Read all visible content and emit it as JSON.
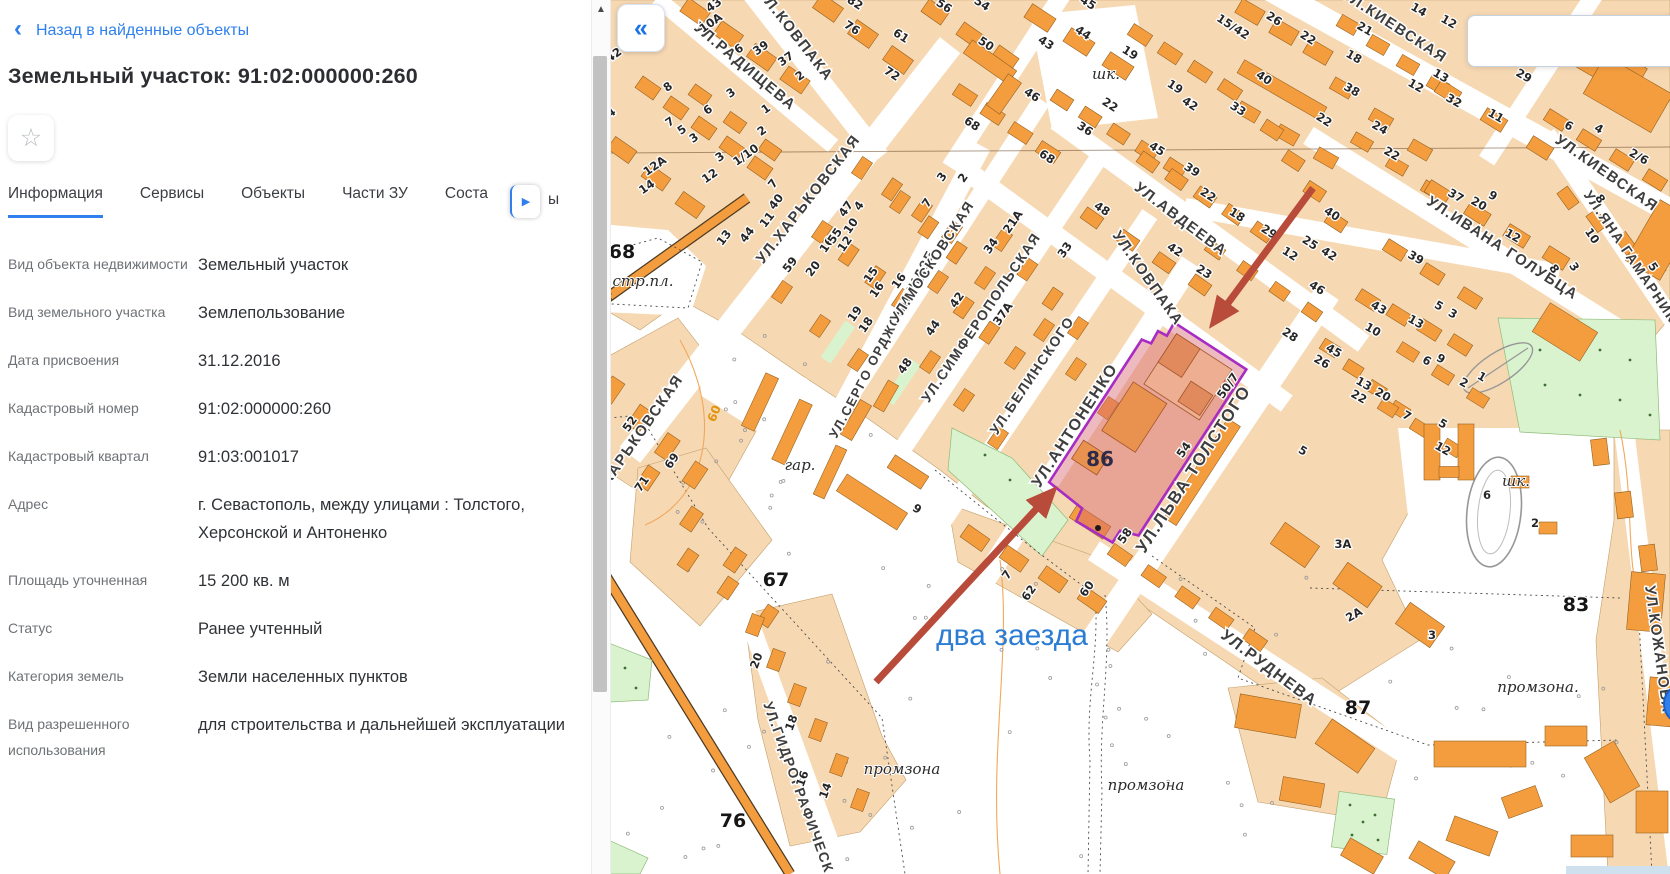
{
  "sidebar": {
    "back_label": "Назад в найденные объекты",
    "title": "Земельный участок: 91:02:000000:260",
    "star_icon": "☆",
    "tabs": [
      {
        "label": "Информация",
        "active": true
      },
      {
        "label": "Сервисы",
        "active": false
      },
      {
        "label": "Объекты",
        "active": false
      },
      {
        "label": "Части ЗУ",
        "active": false
      },
      {
        "label": "Соста",
        "active": false
      }
    ],
    "tab_scroll_icon": "▶",
    "tab_fragment": "ы",
    "fields": [
      {
        "label": "Вид объекта недвижимости",
        "value": "Земельный участок"
      },
      {
        "label": "Вид земельного участка",
        "value": "Землепользование"
      },
      {
        "label": "Дата присвоения",
        "value": "31.12.2016"
      },
      {
        "label": "Кадастровый номер",
        "value": "91:02:000000:260"
      },
      {
        "label": "Кадастровый квартал",
        "value": "91:03:001017"
      },
      {
        "label": "Адрес",
        "value": "г. Севастополь, между улицами : Толстого, Херсонской и Антоненко"
      },
      {
        "label": "Площадь уточненная",
        "value": "15 200 кв. м"
      },
      {
        "label": "Статус",
        "value": "Ранее учтенный"
      },
      {
        "label": "Категория земель",
        "value": "Земли населенных пунктов"
      },
      {
        "label": "Вид разрешенного использования",
        "value": "для строительства и дальнейшей эксплуатации"
      }
    ]
  },
  "map": {
    "collapse_label": "«",
    "annotation": {
      "text": "два заезда",
      "color": "#2b7cd3",
      "x": 1012,
      "y": 645
    },
    "parcel": {
      "number": "86",
      "label_x": 1100,
      "label_y": 466,
      "outline_color": "#a82bc4",
      "fill_color": "rgba(214,102,112,0.45)"
    },
    "street_labels": [
      {
        "t": "УЛ.РАДИЩЕВА",
        "x": 742,
        "y": 70,
        "r": 40,
        "s": 15
      },
      {
        "t": "УЛ.КОВПАКА",
        "x": 792,
        "y": 38,
        "r": 52,
        "s": 15
      },
      {
        "t": "УЛ.ХАРЬКОВСКАЯ",
        "x": 812,
        "y": 202,
        "r": -52,
        "s": 15
      },
      {
        "t": "УЛ.ХАРЬКОВСКАЯ",
        "x": 638,
        "y": 444,
        "r": -55,
        "s": 15
      },
      {
        "t": "УЛ.СЕРГО ОРДЖОНИКИДЗЕ",
        "x": 886,
        "y": 346,
        "r": -62,
        "s": 13
      },
      {
        "t": "УЛ.МОСКОВСКАЯ",
        "x": 936,
        "y": 264,
        "r": -57,
        "s": 14
      },
      {
        "t": "УЛ.СИМФЕРОПОЛЬСКАЯ",
        "x": 985,
        "y": 320,
        "r": -56,
        "s": 14
      },
      {
        "t": "УЛ.БЕЛИНСКОГО",
        "x": 1036,
        "y": 378,
        "r": -56,
        "s": 14
      },
      {
        "t": "УЛ.АНТОНЕНКО",
        "x": 1079,
        "y": 428,
        "r": -57,
        "s": 16
      },
      {
        "t": "УЛ.КОВПАКА",
        "x": 1144,
        "y": 281,
        "r": 55,
        "s": 15
      },
      {
        "t": "УЛ.АВДЕЕВА",
        "x": 1178,
        "y": 223,
        "r": 37,
        "s": 15
      },
      {
        "t": "УЛ.КИЕВСКАЯ",
        "x": 1392,
        "y": 30,
        "r": 33,
        "s": 15
      },
      {
        "t": "УЛ.КИЕВСКАЯ",
        "x": 1604,
        "y": 177,
        "r": 35,
        "s": 15
      },
      {
        "t": "УЛ.ИВАНА ГОЛУБЦА",
        "x": 1500,
        "y": 252,
        "r": 33,
        "s": 15
      },
      {
        "t": "УЛ.ЯНА ГАМАРНИКА",
        "x": 1630,
        "y": 264,
        "r": 56,
        "s": 14
      },
      {
        "t": "УЛ.ЛЬВА ТОЛСТОГО",
        "x": 1198,
        "y": 472,
        "r": -57,
        "s": 17
      },
      {
        "t": "УЛ.РУДНЕВА",
        "x": 1266,
        "y": 672,
        "r": 37,
        "s": 16
      },
      {
        "t": "УЛ.КОЖАНОВА",
        "x": 1654,
        "y": 650,
        "r": 82,
        "s": 15
      },
      {
        "t": "УЛ.ГИДРОГРАФИЧЕСКАЯ",
        "x": 798,
        "y": 800,
        "r": 70,
        "s": 14
      }
    ],
    "building_numbers": [
      [
        "42",
        616,
        58,
        -35
      ],
      [
        "43",
        716,
        8,
        -35
      ],
      [
        "10А",
        713,
        26,
        -35
      ],
      [
        "6",
        741,
        52,
        -35
      ],
      [
        "39",
        763,
        51,
        -35
      ],
      [
        "37",
        788,
        62,
        -35
      ],
      [
        "2",
        802,
        79,
        -35
      ],
      [
        "8",
        670,
        90,
        -35
      ],
      [
        "3",
        733,
        96,
        -35
      ],
      [
        "6",
        710,
        113,
        -35
      ],
      [
        "1",
        768,
        112,
        -35
      ],
      [
        "2",
        764,
        134,
        -35
      ],
      [
        "7",
        672,
        125,
        -35
      ],
      [
        "5",
        684,
        133,
        -35
      ],
      [
        "3",
        696,
        141,
        -35
      ],
      [
        "1/10",
        748,
        158,
        -35
      ],
      [
        "12А",
        657,
        169,
        -35
      ],
      [
        "3",
        722,
        160,
        -35
      ],
      [
        "12",
        712,
        179,
        -35
      ],
      [
        "14",
        649,
        190,
        -35
      ],
      [
        "14",
        610,
        118,
        -35
      ],
      [
        "13",
        727,
        240,
        -52
      ],
      [
        "44",
        750,
        237,
        -52
      ],
      [
        "11",
        770,
        222,
        -52
      ],
      [
        "40",
        779,
        204,
        -52
      ],
      [
        "7",
        776,
        186,
        -52
      ],
      [
        "59",
        793,
        267,
        -52
      ],
      [
        "20",
        816,
        271,
        -52
      ],
      [
        "16",
        830,
        247,
        -55
      ],
      [
        "55",
        838,
        238,
        -55
      ],
      [
        "12",
        848,
        246,
        -55
      ],
      [
        "10",
        854,
        228,
        -55
      ],
      [
        "47",
        849,
        211,
        -55
      ],
      [
        "4",
        862,
        208,
        -55
      ],
      [
        "15",
        874,
        277,
        -55
      ],
      [
        "16",
        880,
        292,
        -55
      ],
      [
        "19",
        858,
        316,
        -55
      ],
      [
        "18",
        869,
        327,
        -55
      ],
      [
        "7",
        930,
        205,
        -55
      ],
      [
        "3",
        945,
        179,
        -55
      ],
      [
        "2",
        966,
        180,
        -55
      ],
      [
        "16",
        902,
        283,
        -55
      ],
      [
        "42",
        960,
        302,
        -55
      ],
      [
        "44",
        936,
        330,
        -55
      ],
      [
        "48",
        908,
        368,
        -55
      ],
      [
        "34",
        994,
        248,
        -55
      ],
      [
        "21А",
        1016,
        224,
        -55
      ],
      [
        "37А",
        1006,
        316,
        -55
      ],
      [
        "33",
        1068,
        252,
        -55
      ],
      [
        "54",
        980,
        7,
        33
      ],
      [
        "50",
        984,
        47,
        33
      ],
      [
        "56",
        942,
        9,
        33
      ],
      [
        "61",
        899,
        39,
        33
      ],
      [
        "76",
        850,
        31,
        33
      ],
      [
        "82",
        853,
        6,
        33
      ],
      [
        "72",
        890,
        77,
        33
      ],
      [
        "46",
        1030,
        98,
        33
      ],
      [
        "68",
        970,
        127,
        33
      ],
      [
        "36",
        1083,
        132,
        33
      ],
      [
        "22",
        1108,
        108,
        33
      ],
      [
        "68",
        1045,
        160,
        33
      ],
      [
        "43",
        1044,
        46,
        33
      ],
      [
        "44",
        1081,
        36,
        33
      ],
      [
        "45",
        1086,
        6,
        33
      ],
      [
        "19",
        1128,
        56,
        33
      ],
      [
        "19",
        1173,
        90,
        33
      ],
      [
        "42",
        1188,
        107,
        33
      ],
      [
        "33",
        1236,
        112,
        33
      ],
      [
        "15/42",
        1231,
        30,
        33
      ],
      [
        "26",
        1272,
        22,
        33
      ],
      [
        "22",
        1306,
        41,
        33
      ],
      [
        "40",
        1262,
        81,
        33
      ],
      [
        "22",
        1322,
        123,
        33
      ],
      [
        "45",
        1155,
        152,
        33
      ],
      [
        "39",
        1190,
        173,
        33
      ],
      [
        "22",
        1206,
        198,
        33
      ],
      [
        "18",
        1235,
        218,
        33
      ],
      [
        "29",
        1267,
        235,
        33
      ],
      [
        "12",
        1288,
        257,
        33
      ],
      [
        "25",
        1308,
        246,
        33
      ],
      [
        "42",
        1327,
        257,
        33
      ],
      [
        "40",
        1330,
        217,
        33
      ],
      [
        "48",
        1100,
        212,
        33
      ],
      [
        "42",
        1173,
        253,
        33
      ],
      [
        "23",
        1202,
        275,
        33
      ],
      [
        "46",
        1315,
        291,
        33
      ],
      [
        "28",
        1288,
        338,
        33
      ],
      [
        "21",
        1363,
        32,
        30
      ],
      [
        "18",
        1352,
        60,
        30
      ],
      [
        "38",
        1350,
        93,
        30
      ],
      [
        "12",
        1414,
        89,
        30
      ],
      [
        "13",
        1439,
        79,
        30
      ],
      [
        "24",
        1378,
        131,
        30
      ],
      [
        "22",
        1390,
        157,
        30
      ],
      [
        "14",
        1417,
        13,
        30
      ],
      [
        "12",
        1447,
        25,
        30
      ],
      [
        "32",
        1452,
        104,
        30
      ],
      [
        "29",
        1522,
        79,
        30
      ],
      [
        "11",
        1494,
        119,
        30
      ],
      [
        "6",
        1567,
        129,
        30
      ],
      [
        "4",
        1597,
        132,
        30
      ],
      [
        "2/6",
        1637,
        160,
        30
      ],
      [
        "37",
        1454,
        199,
        30
      ],
      [
        "20",
        1477,
        207,
        30
      ],
      [
        "9",
        1491,
        199,
        30
      ],
      [
        "12",
        1511,
        239,
        30
      ],
      [
        "39",
        1414,
        261,
        30
      ],
      [
        "8",
        1597,
        201,
        56
      ],
      [
        "10",
        1589,
        238,
        56
      ],
      [
        "8",
        1551,
        271,
        56
      ],
      [
        "3",
        1571,
        269,
        56
      ],
      [
        "5",
        1650,
        269,
        56
      ],
      [
        "43",
        1377,
        311,
        30
      ],
      [
        "13",
        1414,
        325,
        30
      ],
      [
        "10",
        1371,
        333,
        30
      ],
      [
        "5",
        1437,
        309,
        30
      ],
      [
        "3",
        1451,
        317,
        30
      ],
      [
        "26",
        1320,
        365,
        30
      ],
      [
        "45",
        1332,
        354,
        30
      ],
      [
        "13",
        1362,
        387,
        30
      ],
      [
        "22",
        1357,
        400,
        30
      ],
      [
        "20",
        1381,
        398,
        30
      ],
      [
        "7",
        1405,
        419,
        30
      ],
      [
        "5",
        1441,
        427,
        30
      ],
      [
        "12",
        1441,
        452,
        30
      ],
      [
        "5",
        1301,
        454,
        30
      ],
      [
        "6",
        1425,
        364,
        30
      ],
      [
        "9",
        1439,
        362,
        30
      ],
      [
        "2",
        1462,
        386,
        30
      ],
      [
        "1",
        1480,
        380,
        30
      ],
      [
        "6",
        1487,
        499,
        0
      ],
      [
        "2",
        1535,
        527,
        0
      ],
      [
        "3А",
        1343,
        548,
        0
      ],
      [
        "2А",
        1356,
        618,
        -30
      ],
      [
        "3",
        1432,
        639,
        0
      ],
      [
        "50/7",
        1231,
        388,
        -55
      ],
      [
        "54",
        1187,
        452,
        -55
      ],
      [
        "58",
        1128,
        538,
        -55
      ],
      [
        "60",
        1090,
        591,
        -55
      ],
      [
        "62",
        1032,
        595,
        -55
      ],
      [
        "7",
        1010,
        577,
        -55
      ],
      [
        "9",
        915,
        512,
        33
      ],
      [
        "52",
        633,
        426,
        -55
      ],
      [
        "69",
        675,
        463,
        -55
      ],
      [
        "71",
        645,
        486,
        -55
      ],
      [
        "20",
        760,
        662,
        -70
      ],
      [
        "18",
        795,
        724,
        -70
      ],
      [
        "16",
        806,
        780,
        -70
      ],
      [
        "14",
        829,
        792,
        -70
      ]
    ],
    "quarter_numbers": [
      {
        "t": "68",
        "x": 622,
        "y": 258
      },
      {
        "t": "67",
        "x": 776,
        "y": 586
      },
      {
        "t": "76",
        "x": 733,
        "y": 827
      },
      {
        "t": "87",
        "x": 1358,
        "y": 714
      },
      {
        "t": "83",
        "x": 1576,
        "y": 611
      }
    ],
    "place_labels": [
      {
        "t": "стр.пл.",
        "x": 643,
        "y": 286
      },
      {
        "t": "гар.",
        "x": 800,
        "y": 470
      },
      {
        "t": "шк.",
        "x": 1106,
        "y": 79
      },
      {
        "t": "шк.",
        "x": 1516,
        "y": 486
      },
      {
        "t": "промзона",
        "x": 902,
        "y": 774
      },
      {
        "t": "промзона",
        "x": 1146,
        "y": 790
      },
      {
        "t": "промзона.",
        "x": 1538,
        "y": 692
      }
    ],
    "contour_labels": [
      {
        "t": "60",
        "x": 718,
        "y": 415,
        "r": -68
      }
    ]
  },
  "colors": {
    "accent_blue": "#2f80ed",
    "map_building": "#f49d3f",
    "map_block": "#f6d8b2",
    "map_green": "#daf3cf",
    "arrow_red": "#b84b3a",
    "parcel_outline": "#a82bc4"
  }
}
